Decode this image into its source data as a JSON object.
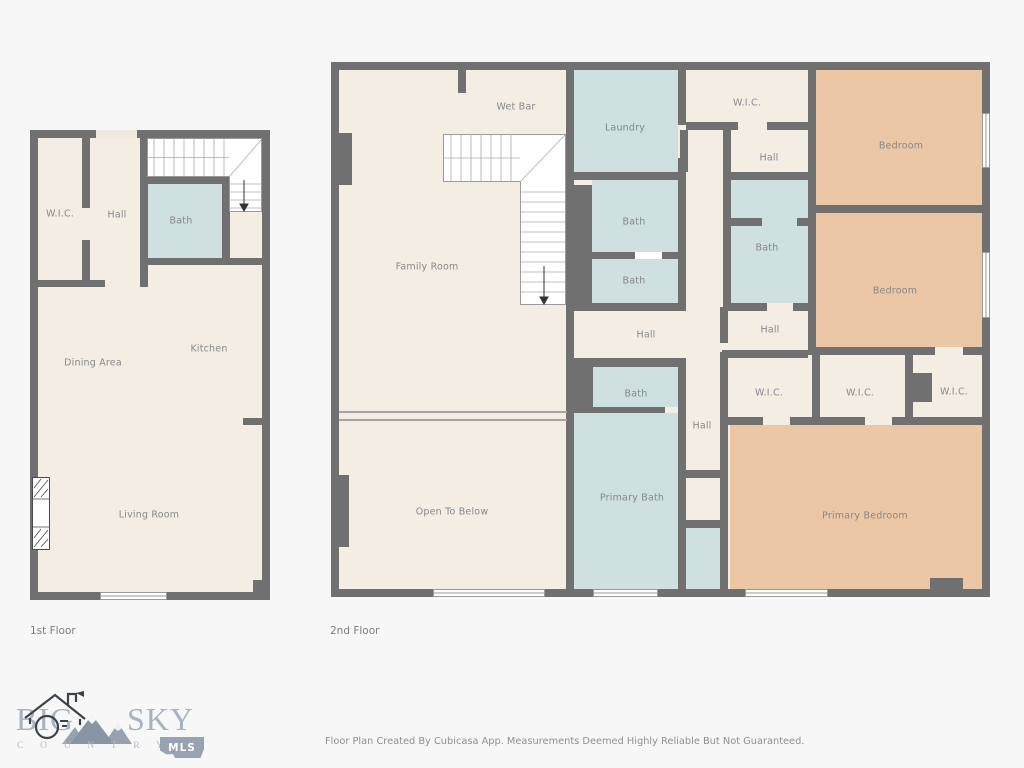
{
  "floor1": {
    "caption": "1st Floor",
    "rooms": {
      "wic": "W.I.C.",
      "hall": "Hall",
      "bath": "Bath",
      "kitchen": "Kitchen",
      "dining": "Dining Area",
      "living": "Living Room"
    }
  },
  "floor2": {
    "caption": "2nd Floor",
    "rooms": {
      "wet_bar": "Wet Bar",
      "laundry": "Laundry",
      "wic_top": "W.I.C.",
      "hall_top": "Hall",
      "bedroom_top": "Bedroom",
      "bedroom_mid": "Bedroom",
      "family_room": "Family Room",
      "bath_a": "Bath",
      "bath_b": "Bath",
      "bath_right": "Bath",
      "hall_center": "Hall",
      "hall_right": "Hall",
      "bath_lower": "Bath",
      "hall_lower": "Hall",
      "wic_1": "W.I.C.",
      "wic_2": "W.I.C.",
      "wic_3": "W.I.C.",
      "primary_bath": "Primary Bath",
      "open_to_below": "Open To Below",
      "primary_bedroom": "Primary Bedroom"
    }
  },
  "logo": {
    "word_big": "BIG",
    "word_sky": "SKY",
    "word_country": "C O U N T R Y",
    "badge": "MLS"
  },
  "footer": {
    "disclaimer": "Floor Plan Created By Cubicasa App. Measurements Deemed Highly Reliable But Not Guaranteed."
  },
  "colors": {
    "wall": "#707070",
    "floor": "#f4ede4",
    "wet_room": "#cfe0e1",
    "bedroom": "#ecc7a5",
    "background": "#f7f7f7",
    "label_text": "#85888d"
  }
}
